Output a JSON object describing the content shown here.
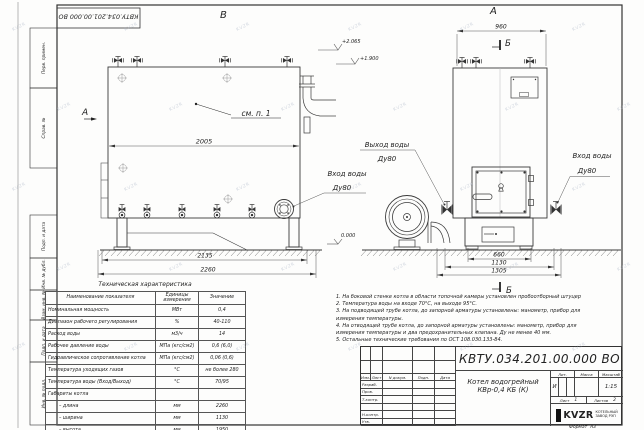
{
  "watermark": "KVZR",
  "frame_labels": [
    "Перв. примен.",
    "Справ. №",
    "Подп. и дата",
    "Инв. № дубл.",
    "Взам. инв. №",
    "Подп. и дата",
    "Инв. № подл."
  ],
  "d": {
    "stamp": "КВТУ.034.201.00.000 ВО",
    "view_b": "В",
    "view_a_top": "А",
    "view_a_side": "А",
    "sec_b_top": "Б",
    "sec_b_bot": "Б",
    "callout": "см. п. 1",
    "dim2005": "2005",
    "dim2135": "2135",
    "dim2260": "2260",
    "dim960": "960",
    "dim660": "660",
    "dim1130": "1130",
    "dim1305": "1305",
    "elev1": "+2.065",
    "elev2": "+1.900",
    "elev0": "0.000",
    "out_l1": "Выход воды",
    "out_l2": "Ду80",
    "in1_l1": "Вход воды",
    "in1_l2": "Ду80",
    "in2_l1": "Вход воды",
    "in2_l2": "Ду80"
  },
  "tech_table": {
    "title": "Техническая характеристика",
    "headers": [
      "Наименование показателя",
      "Единицы измерения",
      "Значение"
    ],
    "rows": [
      [
        "Номинальная мощность",
        "МВт",
        "0,4"
      ],
      [
        "Диапазон рабочего регулирования",
        "%",
        "40-110"
      ],
      [
        "Расход воды",
        "м3/ч",
        "14"
      ],
      [
        "Рабочее давление воды",
        "МПа (кгс/см2)",
        "0,6 (6,0)"
      ],
      [
        "Гидравлическое сопротивление котла",
        "МПа (кгс/см2)",
        "0,06 (0,6)"
      ],
      [
        "Температура уходящих газов",
        "°С",
        "не более 280"
      ],
      [
        "Температура воды (Вход/Выход)",
        "°С",
        "70/95"
      ],
      [
        "Габариты котла",
        "",
        ""
      ],
      [
        "– длина",
        "мм",
        "2260"
      ],
      [
        "– ширина",
        "мм",
        "1130"
      ],
      [
        "– высота",
        "мм",
        "1950"
      ]
    ]
  },
  "notes": {
    "lines": [
      "1.  На боковой стенке котла в области топочной камеры установлен пробоотборный штуцер",
      "2.  Температура воды на входе 70°С, на выходе 95°С.",
      "3.  На подводящей трубе котла, до запорной арматуры установлены: манометр, прибор для",
      "измерения температуры.",
      "4.  На отводящей трубе котла, до запорной арматуры установлены: манометр, прибор для",
      "измерения температуры и два предохранительных клапана. Ду не менее 40 мм.",
      "5.  Остальные технические требования по ОСТ 108.030.133-84."
    ]
  },
  "tb": {
    "doc_number": "КВТУ.034.201.00.000 ВО",
    "cols": [
      "Изм.",
      "Лист",
      "N докум.",
      "Подп.",
      "Дата"
    ],
    "rows": [
      "Разраб.",
      "Пров.",
      "Т.контр.",
      "Н.контр.",
      "Утв."
    ],
    "name1": "Котел водогрейный",
    "name2": "КВр-0,4  КБ  (К)",
    "lit_label": "Лит.",
    "lit_value": "И",
    "mass_label": "Масса",
    "scale_label": "Масштаб",
    "scale_value": "1:15",
    "sheet_label": "Лист",
    "sheet_value": "1",
    "sheets_label": "Листов",
    "sheets_value": "2",
    "logo": "KVZR",
    "co1": "КОТЕЛЬНЫЙ",
    "co2": "ЗАВОД РЭП",
    "format_label": "Формат",
    "format_value": "А3"
  }
}
